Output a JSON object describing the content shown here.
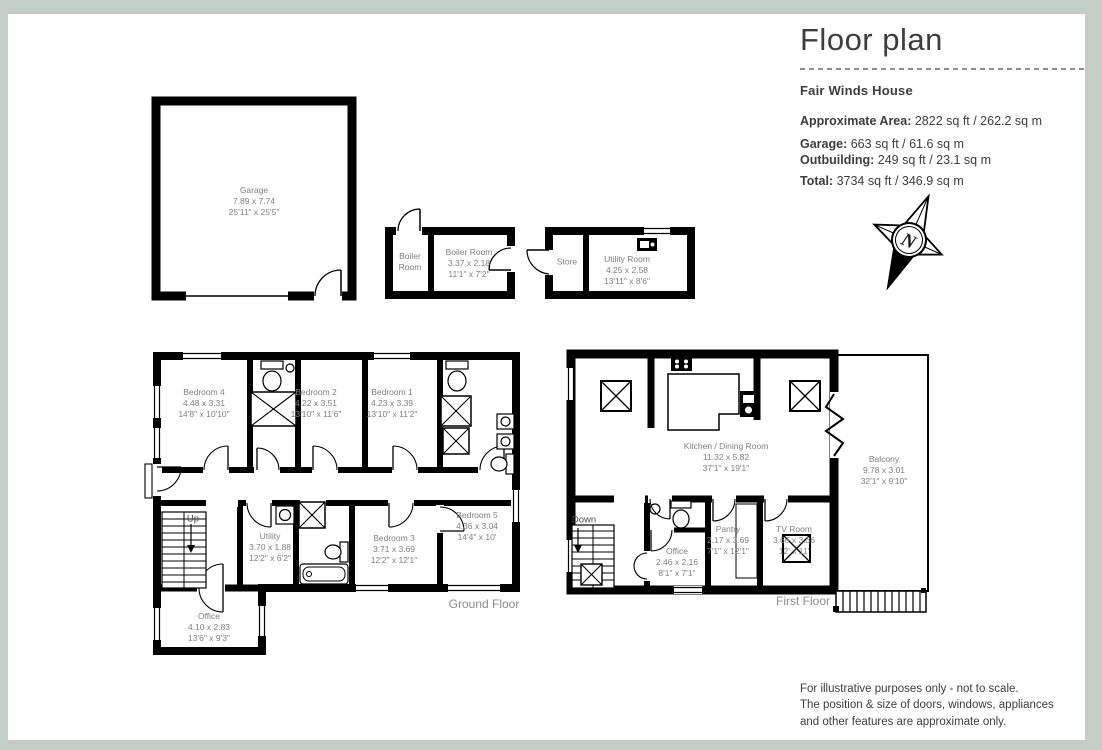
{
  "header": {
    "title": "Floor plan",
    "property_name": "Fair Winds House",
    "areas": [
      {
        "label": "Approximate Area:",
        "value": "2822 sq ft / 262.2 sq m"
      },
      {
        "label": "Garage:",
        "value": "663 sq ft / 61.6 sq m"
      },
      {
        "label": "Outbuilding:",
        "value": "249 sq ft / 23.1 sq m"
      },
      {
        "label": "Total:",
        "value": "3734 sq ft / 346.9 sq m"
      }
    ],
    "compass_letter": "N"
  },
  "rooms": {
    "garage": {
      "name": "Garage",
      "metric": "7.89 x 7.74",
      "imperial": "25'11\" x 25'5\""
    },
    "boiler_lobby": {
      "name": "Boiler Room"
    },
    "boiler_room": {
      "name": "Boiler Room",
      "metric": "3.37 x 2.18",
      "imperial": "11'1\" x 7'2\""
    },
    "store": {
      "name": "Store"
    },
    "utility_room": {
      "name": "Utility Room",
      "metric": "4.25 x 2.58",
      "imperial": "13'11\" x 8'6\""
    },
    "bedroom4": {
      "name": "Bedroom 4",
      "metric": "4.48 x 3.31",
      "imperial": "14'8\" x 10'10\""
    },
    "bedroom2": {
      "name": "Bedroom 2",
      "metric": "4.22 x 3.51",
      "imperial": "13'10\" x 11'6\""
    },
    "bedroom1": {
      "name": "Bedroom 1",
      "metric": "4.23 x 3.39",
      "imperial": "13'10\" x 11'2\""
    },
    "utility": {
      "name": "Utility",
      "metric": "3.70 x 1.88",
      "imperial": "12'2\" x 6'2\""
    },
    "bedroom3": {
      "name": "Bedroom 3",
      "metric": "3.71 x 3.69",
      "imperial": "12'2\" x 12'1\""
    },
    "bedroom5": {
      "name": "Bedroom 5",
      "metric": "4.36 x 3.04",
      "imperial": "14'4\" x 10'"
    },
    "office_ground": {
      "name": "Office",
      "metric": "4.10 x 2.83",
      "imperial": "13'6\" x 9'3\""
    },
    "kitchen_dining": {
      "name": "Kitchen / Dining Room",
      "metric": "11.32 x 5.82",
      "imperial": "37'1\" x 19'1\""
    },
    "balcony": {
      "name": "Balcony",
      "metric": "9.78 x 3.01",
      "imperial": "32'1\" x 9'10\""
    },
    "office_first": {
      "name": "Office",
      "metric": "2.46 x 2.16",
      "imperial": "8'1\" x 7'1\""
    },
    "pantry": {
      "name": "Pantry",
      "metric": "2.17 x 3.69",
      "imperial": "7'1\" x 12'1\""
    },
    "tv_room": {
      "name": "TV Room",
      "metric": "3.66 x 3.36",
      "imperial": "12' x 11'"
    }
  },
  "stairs": {
    "up": "Up",
    "down": "Down"
  },
  "floor_labels": {
    "ground": "Ground Floor",
    "first": "First Floor"
  },
  "footer": {
    "line1": "For illustrative purposes only - not to scale.",
    "line2": "The position & size of doors, windows, appliances",
    "line3": "and other features are approximate only."
  },
  "colors": {
    "page_border": "#c2cec5",
    "walls": "#000000",
    "room_text": "#7f7f7f",
    "heading_text": "#3d3d3d"
  }
}
